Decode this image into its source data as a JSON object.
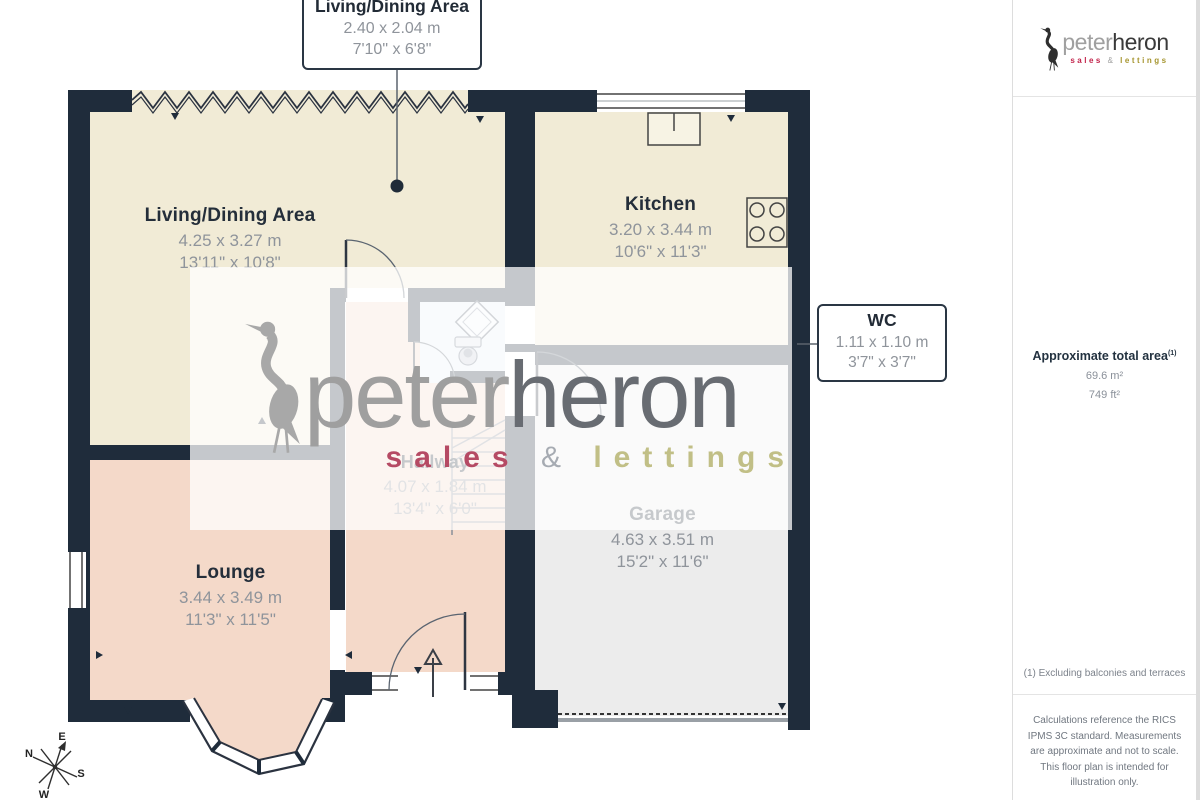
{
  "plan": {
    "callout_living": {
      "title": "Living/Dining Area",
      "metric": "2.40 x 2.04 m",
      "imperial": "7'10\" x 6'8\""
    },
    "callout_wc": {
      "title": "WC",
      "metric": "1.11 x 1.10 m",
      "imperial": "3'7\" x 3'7\""
    },
    "rooms": {
      "living": {
        "name": "Living/Dining Area",
        "metric": "4.25 x 3.27 m",
        "imperial": "13'11\" x 10'8\""
      },
      "kitchen": {
        "name": "Kitchen",
        "metric": "3.20 x 3.44 m",
        "imperial": "10'6\" x 11'3\""
      },
      "hallway": {
        "name": "Hallway",
        "metric": "4.07 x 1.84 m",
        "imperial": "13'4\" x 6'0\""
      },
      "garage": {
        "name": "Garage",
        "metric": "4.63 x 3.51 m",
        "imperial": "15'2\" x 11'6\""
      },
      "lounge": {
        "name": "Lounge",
        "metric": "3.44 x 3.49 m",
        "imperial": "11'3\" x 11'5\""
      }
    },
    "compass": {
      "n": "N",
      "e": "E",
      "s": "S",
      "w": "W"
    }
  },
  "watermark": {
    "brand_left": "peter",
    "brand_right": "heron",
    "sales": "sales",
    "amp": "&",
    "lettings": "lettings"
  },
  "sidebar": {
    "logo": {
      "brand_left": "peter",
      "brand_right": "heron",
      "sales": "sales",
      "amp": "&",
      "lettings": "lettings"
    },
    "area_title": "Approximate total area",
    "area_sup": "(1)",
    "area_m2": "69.6 m²",
    "area_ft2": "749 ft²",
    "footnote": "(1) Excluding balconies and terraces",
    "disclaimer": "Calculations reference the RICS IPMS 3C standard. Measurements are approximate and not to scale. This floor plan is intended for illustration only.",
    "credit_left": "GIRAFFE",
    "credit_right": "360"
  },
  "colors": {
    "wall": "#1f2c3b",
    "cream": "#f1ebd6",
    "pink": "#f4d9c9",
    "garage": "#ececec",
    "wc": "#e9eef7",
    "accent_sales": "#c2224a",
    "accent_lettings": "#a6952f"
  }
}
